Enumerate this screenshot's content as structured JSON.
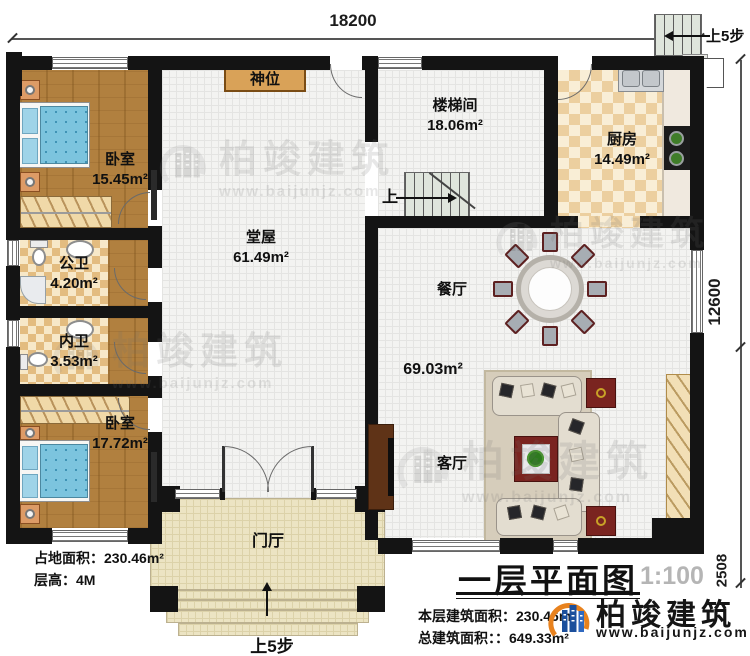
{
  "dimensions": {
    "top": "18200",
    "right": "12600",
    "right_lower": "2508"
  },
  "stairs": {
    "up_interior": "上",
    "up_exterior_top": "上5步",
    "up_entrance": "上5步"
  },
  "rooms": {
    "shrine": {
      "label": "神位"
    },
    "bedroom_top": {
      "label": "卧室",
      "area": "15.45m²"
    },
    "stairwell": {
      "label": "楼梯间",
      "area": "18.06m²"
    },
    "kitchen": {
      "label": "厨房",
      "area": "14.49m²"
    },
    "hall": {
      "label": "堂屋",
      "area": "61.49m²"
    },
    "public_bath": {
      "label": "公卫",
      "area": "4.20m²"
    },
    "private_bath": {
      "label": "内卫",
      "area": "3.53m²"
    },
    "bedroom_bottom": {
      "label": "卧室",
      "area": "17.72m²"
    },
    "dining": {
      "label": "餐厅"
    },
    "dining_living": {
      "area": "69.03m²"
    },
    "living": {
      "label": "客厅"
    },
    "foyer": {
      "label": "门厅"
    }
  },
  "notes": {
    "site_area": "占地面积：230.46m²",
    "floor_height": "层高：4M"
  },
  "title_block": {
    "title": "一层平面图",
    "scale": "1:100",
    "floor_area": "本层建筑面积：230.46m²",
    "total_area": "总建筑面积：：649.33m²",
    "brand": "柏竣建筑",
    "website": "www.baijunjz.com"
  },
  "watermark": {
    "brand": "柏竣建筑",
    "website": "www.baijunjz.com"
  },
  "colors": {
    "wall": "#141414",
    "wood": "#b1803f",
    "bath_tile": "#e3bc80",
    "kitchen_tile": "#eccf9f",
    "foyer": "#ece4c3",
    "mattress": "#7cc4de",
    "brand_blue": "#1b4f9c",
    "brand_orange": "#e8821e"
  }
}
